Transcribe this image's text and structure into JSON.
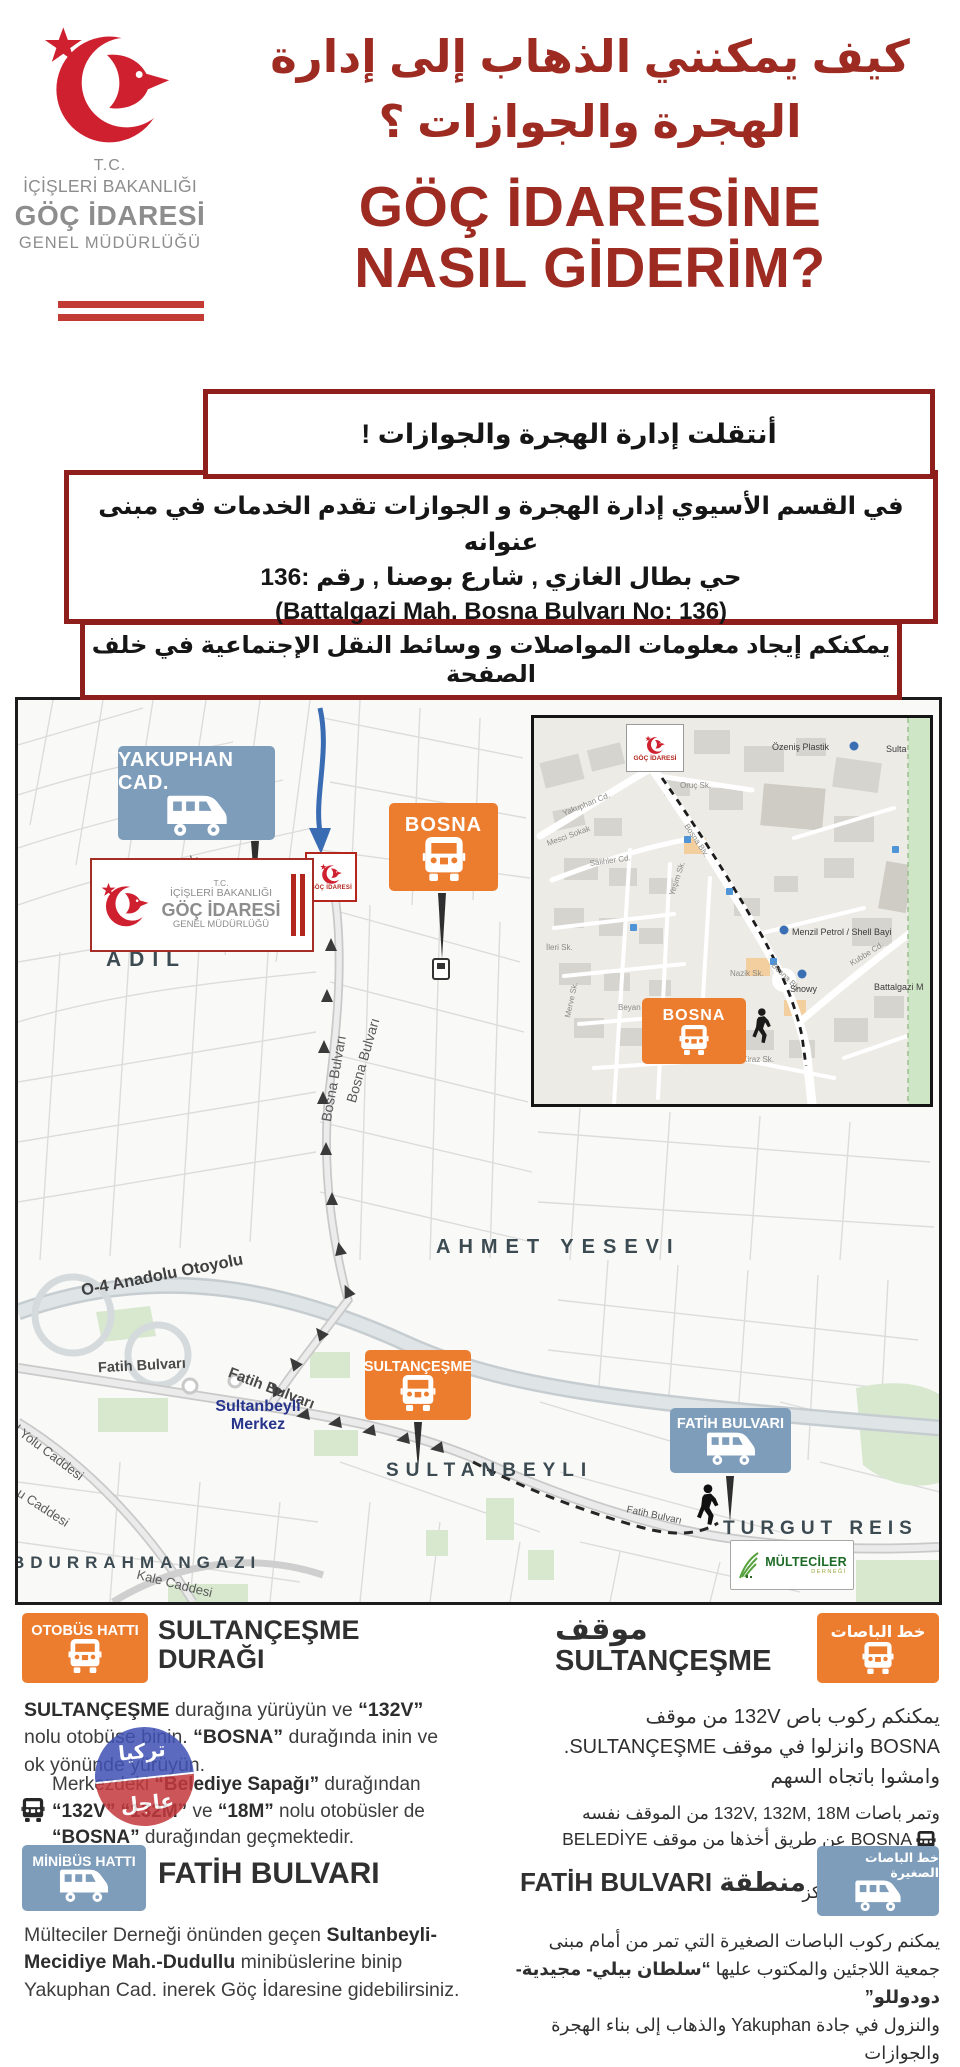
{
  "colors": {
    "brand_red": "#cf2030",
    "title_red": "#9e2b22",
    "box_border": "#8e1f1c",
    "orange": "#ED7D2E",
    "steel_blue": "#7E9DBB",
    "logo_gray": "#8d8d8d",
    "text_dark": "#3d3d3d"
  },
  "header": {
    "tc": "T.C.",
    "ministry": "İÇİŞLERİ BAKANLIĞI",
    "org": "GÖÇ İDARESİ",
    "sub": "GENEL MÜDÜRLÜĞÜ",
    "ar1": "كيف يمكنني الذهاب إلى إدارة",
    "ar2": "الهجرة والجوازات ؟",
    "tr1": "GÖÇ İDARESİNE",
    "tr2": "NASIL GİDERİM?"
  },
  "boxes": {
    "b1": "أنتقلت إدارة الهجرة والجوازات !",
    "b2l1": "في القسم الأسيوي إدارة الهجرة و الجوازات  تقدم الخدمات في مبنى عنوانه",
    "b2l2": "حي بطال الغازي , شارع بوصنا , رقم :136",
    "b2l3": "(Battalgazi Mah. Bosna Bulvarı No: 136)",
    "b3": "يمكنكم إيجاد معلومات المواصلات و  وسائط النقل الإجتماعية في خلف الصفحة"
  },
  "map": {
    "badge_yakuphan": "YAKUPHAN CAD.",
    "badge_bosna": "BOSNA",
    "badge_sultancesme": "SULTANÇEŞME",
    "badge_fatih": "FATİH BULVARI",
    "marker_goc": "GÖÇ İDARESİ",
    "area_adil": "ADIL",
    "area_ahmet": "AHMET YESEVI",
    "area_sultanbeyli": "SULTANBEYLI",
    "area_turgut": "TURGUT REIS",
    "area_bdurrahman": "BDURRAHMANGAZI",
    "st_yakuphan": "Yakuphan Caddesi",
    "st_bosna": "Bosna Bulvarı",
    "st_o4": "O-4 Anadolu Otoyolu",
    "st_fatih": "Fatih Bulvarı",
    "st_merkez1": "Sultanbeyli",
    "st_merkez2": "Merkez",
    "st_yolu": "l Yolu Caddesi",
    "st_ucad": "u Caddesi",
    "st_kale": "Kale Caddesi",
    "multeciler1": "MÜLTECİLER",
    "multeciler2": "DERNEĞİ",
    "in_marker": "GÖÇ İDARESİ",
    "in_bosna": "BOSNA",
    "in_st1": "Yakuphan Cd.",
    "in_st2": "Oruç Sk.",
    "in_st3": "Bosna Blv.",
    "in_st4": "Salihler Cd.",
    "in_st5": "Mesci Sokak",
    "in_st6": "Kubbe Cd.",
    "in_st7": "Nazik Sk.",
    "in_st8": "Kiraz Sk.",
    "in_st9": "Beyan Sk.",
    "in_st10": "Merve Sk.",
    "in_st11": "İleri Sk.",
    "in_st12": "Yeşim Sk.",
    "in_st13": "Bosna Blv",
    "in_poi1": "Özeniş Plastik",
    "in_poi2": "Menzil Petrol / Shell Bayi",
    "in_poi3": "Snowy",
    "in_poi4": "Battalgazi M",
    "in_poi5": "Sulta"
  },
  "left_col": {
    "badge1": "OTOBÜS HATTI",
    "h1a": "SULTANÇEŞME",
    "h1b": "DURAĞI",
    "p1b1": "SULTANÇEŞME",
    "p1t1": " durağına yürüyün ve ",
    "p1b2": "“132V”",
    "p1t2": " nolu otobüse binin. ",
    "p1b3": "“BOSNA”",
    "p1t3": " durağında inin ve ok yönünde yürüyün.",
    "p2t1": "Merkezdeki ",
    "p2b1": "“Belediye Sapağı”",
    "p2t2": " durağından ",
    "p2b2": "“132V” “132M”",
    "p2t3": " ve ",
    "p2b3": "“18M”",
    "p2t4": " nolu otobüsler de ",
    "p2b4": "“BOSNA”",
    "p2t5": " durağından geçmektedir.",
    "badge2": "MİNİBÜS HATTI",
    "h2": "FATİH BULVARI",
    "p3t1": "Mülteciler Derneği önünden geçen ",
    "p3b1": "Sultanbeyli-Mecidiye Mah.-Dudullu",
    "p3t2": " minibüslerine binip Yakuphan Cad. inerek Göç İdaresine gidebilirsiniz."
  },
  "right_col": {
    "badge1": "خط الباصات",
    "h1a": "موقف",
    "h1b": "SULTANÇEŞME",
    "p1l1": "يمكنكم ركوب باص 132V من موقف",
    "p1l2": "BOSNA وانزلوا في موقف SULTANÇEŞME‎.",
    "p1l3": "وامشوا باتجاه السهم",
    "p2l1": "وتمر باصات 132V, 132M, 18M من الموقف نفسه",
    "p2l2": "BOSNA عن طريق أخذها من موقف BELEDİYE SAPAĞI",
    "p2l3": "الموجود في المركز",
    "badge2": "خط الباصات الصغيرة",
    "h2": "منطقة FATİH BULVARI",
    "p3l1": "يمكنم ركوب الباصات الصغيرة التي تمر من أمام مبنى",
    "p3l2a": "جمعية اللاجئين والمكتوب عليها ",
    "p3l2b": "“سلطان بيلي- مجيدية- دودوللو”",
    "p3l3": "والنزول في جادة Yakuphan والذهاب إلى بناء الهجرة والجوازات"
  },
  "watermark": {
    "w1": "تركيا",
    "w2": "عاجل"
  }
}
